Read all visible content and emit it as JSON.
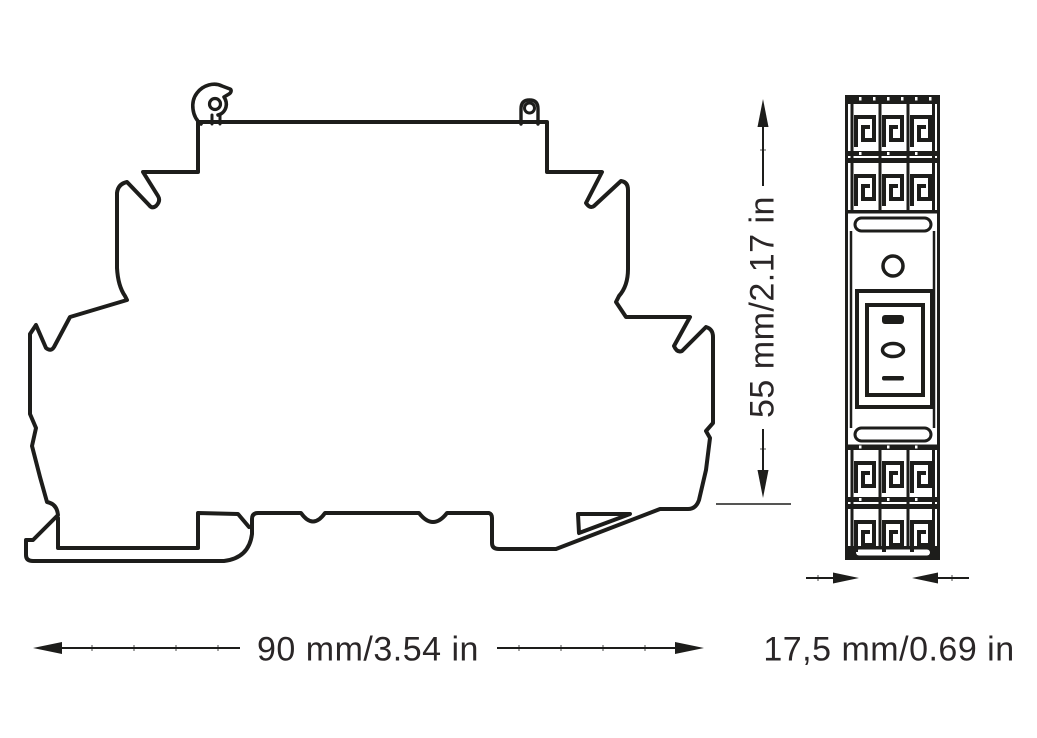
{
  "colors": {
    "background": "#ffffff",
    "line": "#1d1d1b",
    "text": "#2a2627"
  },
  "drawing_type": "dimensional-drawing-din-rail-relay-module",
  "views": {
    "side_view": "side-profile-outline",
    "front_view": "front-face-with-terminals"
  },
  "dimensions": {
    "width": {
      "label": "90 mm/3.54 in"
    },
    "height": {
      "label": "55 mm/2.17 in"
    },
    "depth": {
      "label": "17,5 mm/0.69 in"
    }
  }
}
